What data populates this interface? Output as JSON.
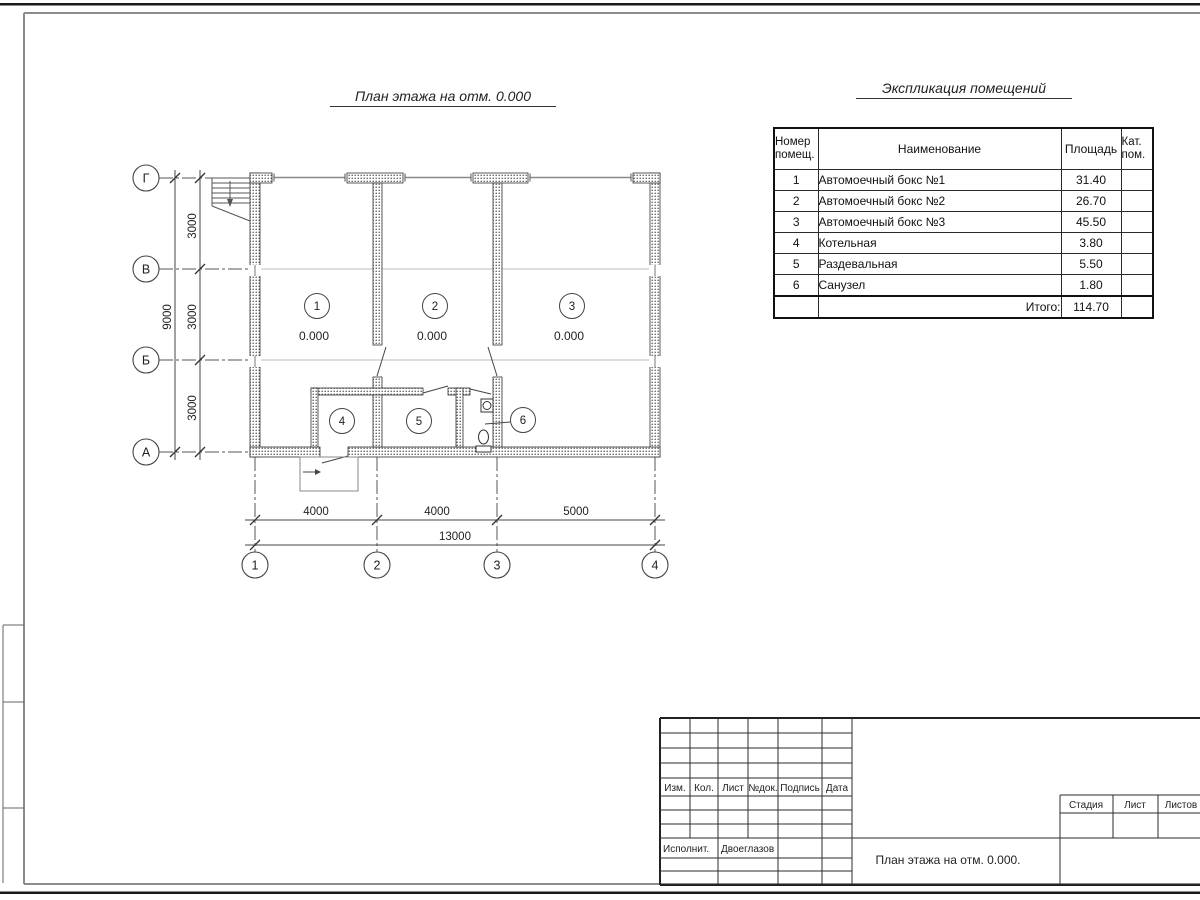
{
  "plan": {
    "title": "План этажа на отм. 0.000",
    "axes": {
      "rows": [
        "Г",
        "В",
        "Б",
        "А"
      ],
      "cols": [
        "1",
        "2",
        "3",
        "4"
      ]
    },
    "dimensions": {
      "vertical_segments": [
        "3000",
        "3000",
        "3000"
      ],
      "vertical_total": "9000",
      "horizontal_segments": [
        "4000",
        "4000",
        "5000"
      ],
      "horizontal_total": "13000"
    },
    "rooms": [
      {
        "number": "1",
        "level": "0.000"
      },
      {
        "number": "2",
        "level": "0.000"
      },
      {
        "number": "3",
        "level": "0.000"
      },
      {
        "number": "4",
        "level": ""
      },
      {
        "number": "5",
        "level": ""
      },
      {
        "number": "6",
        "level": ""
      }
    ]
  },
  "explication": {
    "title": "Экспликация помещений",
    "headers": {
      "number": "Номер помещ.",
      "name": "Наименование",
      "area": "Площадь",
      "category": "Кат. пом."
    },
    "rows": [
      {
        "number": "1",
        "name": "Автомоечный бокс №1",
        "area": "31.40",
        "category": ""
      },
      {
        "number": "2",
        "name": "Автомоечный бокс №2",
        "area": "26.70",
        "category": ""
      },
      {
        "number": "3",
        "name": "Автомоечный бокс №3",
        "area": "45.50",
        "category": ""
      },
      {
        "number": "4",
        "name": "Котельная",
        "area": "3.80",
        "category": ""
      },
      {
        "number": "5",
        "name": "Раздевальная",
        "area": "5.50",
        "category": ""
      },
      {
        "number": "6",
        "name": "Санузел",
        "area": "1.80",
        "category": ""
      }
    ],
    "total": {
      "label": "Итого:",
      "area": "114.70"
    }
  },
  "title_block": {
    "columns": [
      "Изм.",
      "Кол.",
      "Лист",
      "№док.",
      "Подпись",
      "Дата"
    ],
    "executor_label": "Исполнит.",
    "executor_name": "Двоеглазов",
    "doc_title": "План этажа на отм. 0.000.",
    "stage_label": "Стадия",
    "sheet_label": "Лист",
    "sheets_label": "Листов"
  }
}
